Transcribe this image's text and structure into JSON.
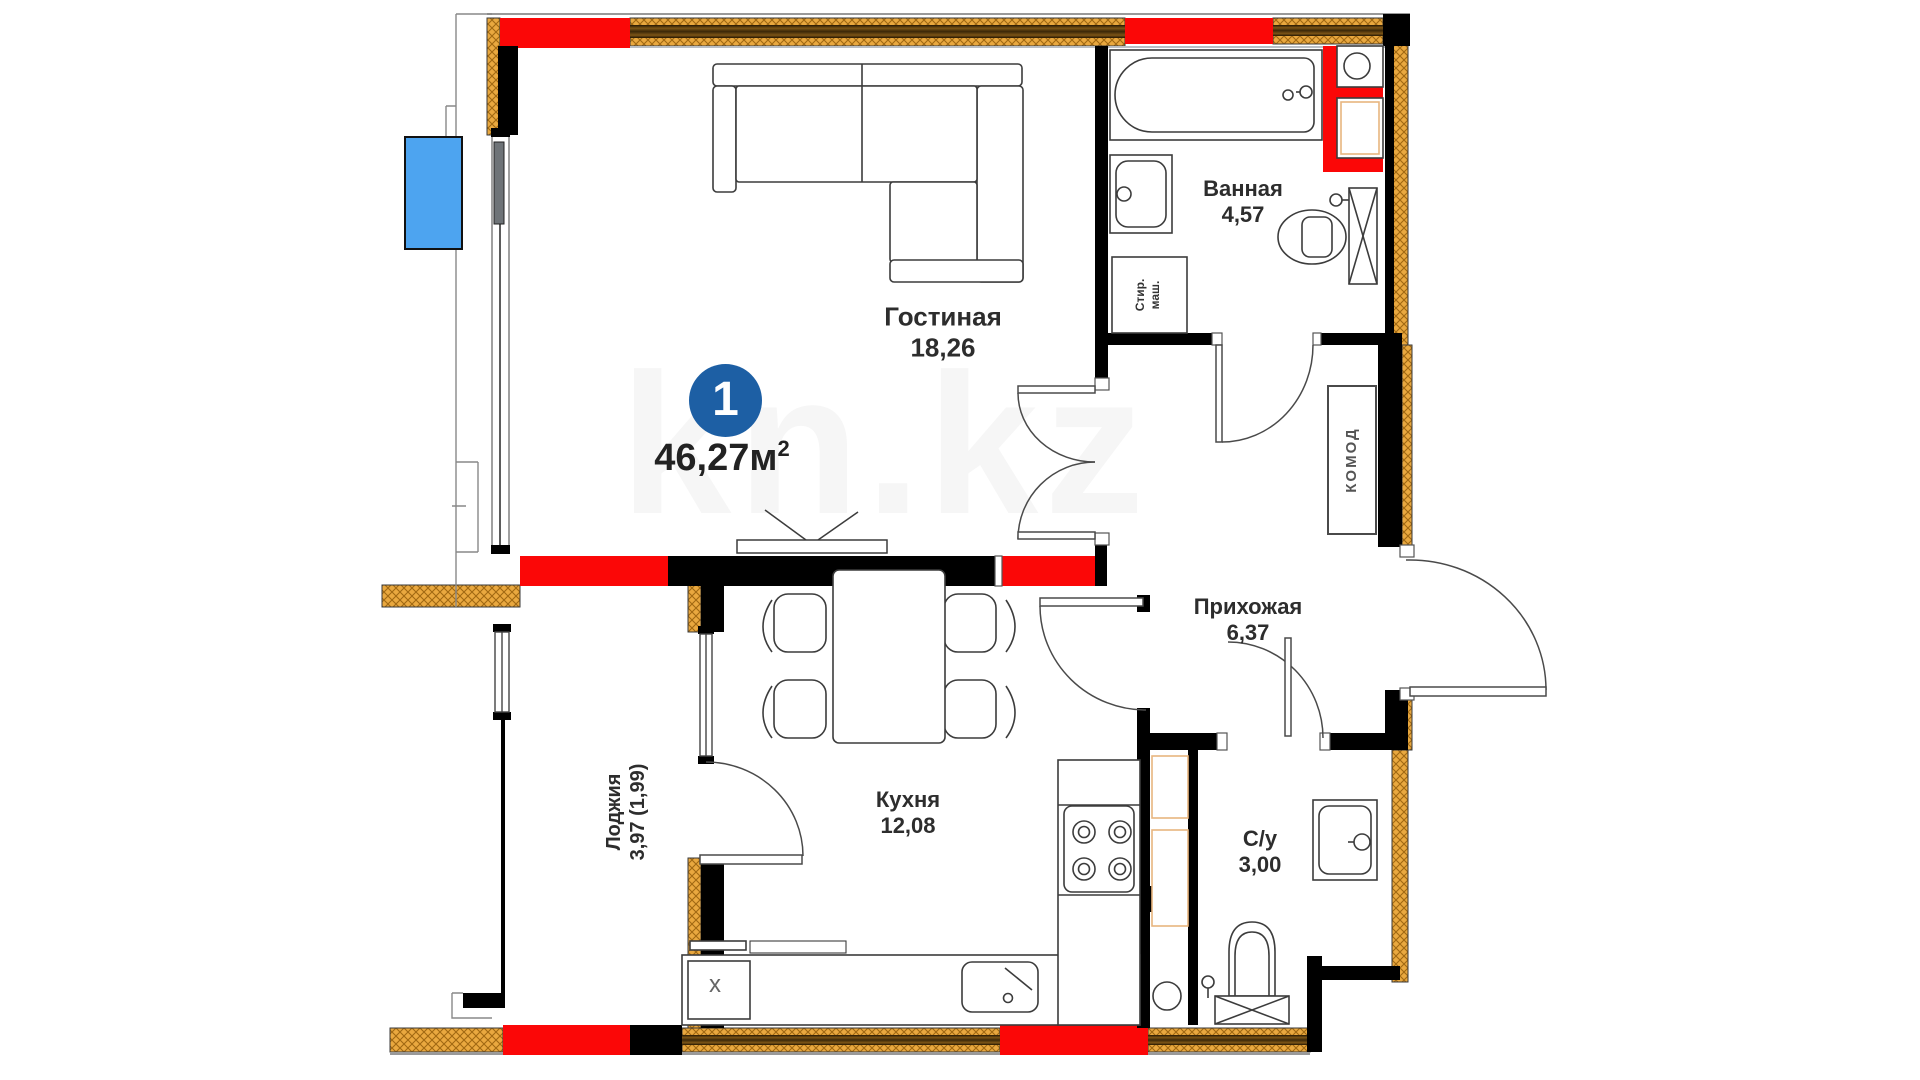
{
  "plan": {
    "unit_badge": {
      "number": "1",
      "area_label": "46,27м",
      "area_sup": "2"
    },
    "rooms": [
      {
        "id": "living",
        "name": "Гостиная",
        "area": "18,26"
      },
      {
        "id": "bathroom",
        "name": "Ванная",
        "area": "4,57"
      },
      {
        "id": "hallway",
        "name": "Прихожая",
        "area": "6,37"
      },
      {
        "id": "kitchen",
        "name": "Кухня",
        "area": "12,08"
      },
      {
        "id": "wc",
        "name": "С/у",
        "area": "3,00"
      },
      {
        "id": "loggia",
        "name": "Лоджия",
        "area": "3,97 (1,99)"
      }
    ],
    "labels": {
      "dresser": "КОМОД",
      "washer_line1": "Стир.",
      "washer_line2": "маш.",
      "kitchen_unit_mark": "х"
    },
    "watermark": "kn.kz",
    "colors": {
      "wall_red": "#FB0707",
      "hatch_base": "#E9A83F",
      "accent_blue": "#1D5FA4",
      "window_blue": "#4DA4F0"
    }
  }
}
